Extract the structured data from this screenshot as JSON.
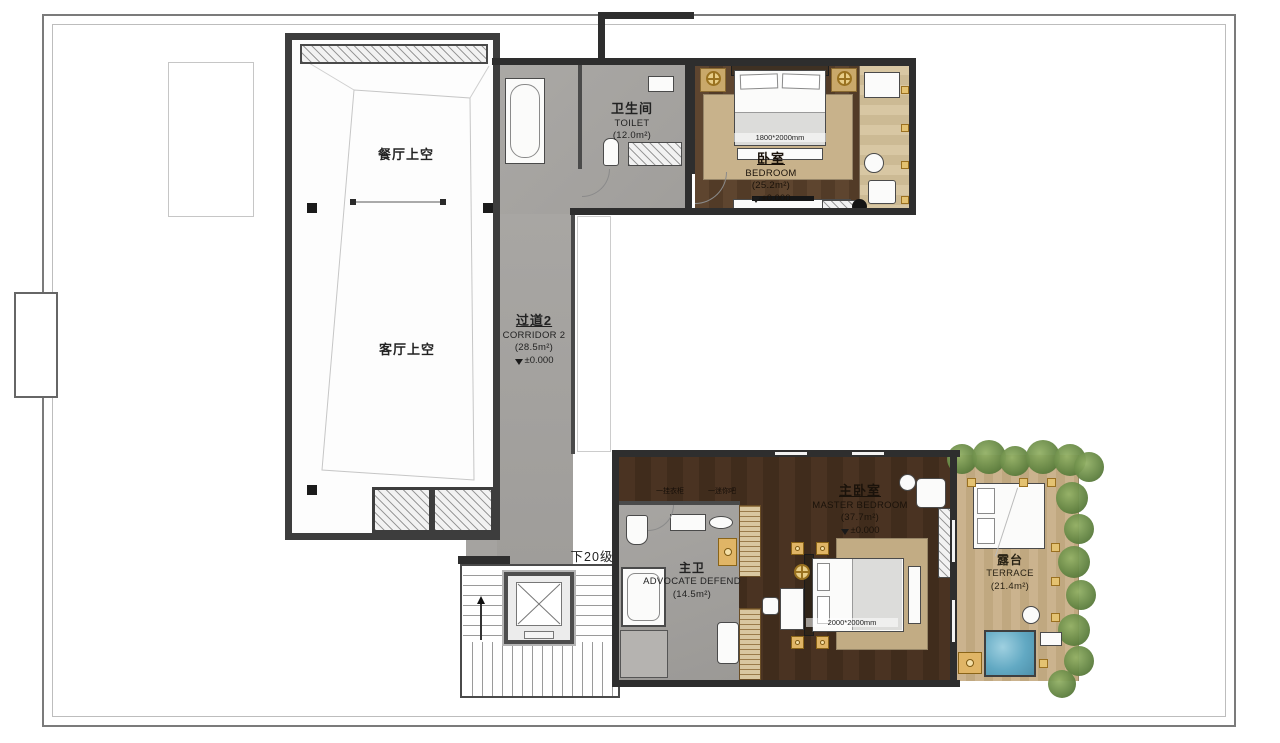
{
  "rooms": {
    "dining_void": {
      "cn": "餐厅上空"
    },
    "living_void": {
      "cn": "客厅上空"
    },
    "toilet": {
      "cn": "卫生间",
      "en": "TOILET",
      "area": "(12.0m²)"
    },
    "bedroom": {
      "cn": "卧室",
      "en": "BEDROOM",
      "area": "(25.2m²)",
      "level": "±0.000",
      "bed_size": "1800*2000mm"
    },
    "corridor": {
      "cn": "过道2",
      "en": "CORRIDOR 2",
      "area": "(28.5m²)",
      "level": "±0.000"
    },
    "master_bedroom": {
      "cn": "主卧室",
      "en": "MASTER BEDROOM",
      "area": "(37.7m²)",
      "level": "±0.000",
      "bed_size": "2000*2000mm"
    },
    "master_bath": {
      "cn": "主卫",
      "en": "ADVOCATE DEFEND",
      "area": "(14.5m²)"
    },
    "terrace": {
      "cn": "露台",
      "en": "TERRACE",
      "area": "(21.4m²)"
    }
  },
  "annotations": {
    "stair_note": "下20级",
    "door_tag": "1",
    "closet_note": "一挂衣柜",
    "minibar_note": "一迷你吧"
  },
  "colors": {
    "wall": "#2e2e2e",
    "corridor_floor": "#a5a3a0",
    "wood_dark_bedroom": "#5a4230",
    "wood_dark_master": "#45301f",
    "wood_light": "#d2bf9b",
    "rug": "#c6b089",
    "plant_green": "#5d7f3e",
    "spa_blue": "#62a9c3",
    "gold_accent": "#b8860b"
  }
}
